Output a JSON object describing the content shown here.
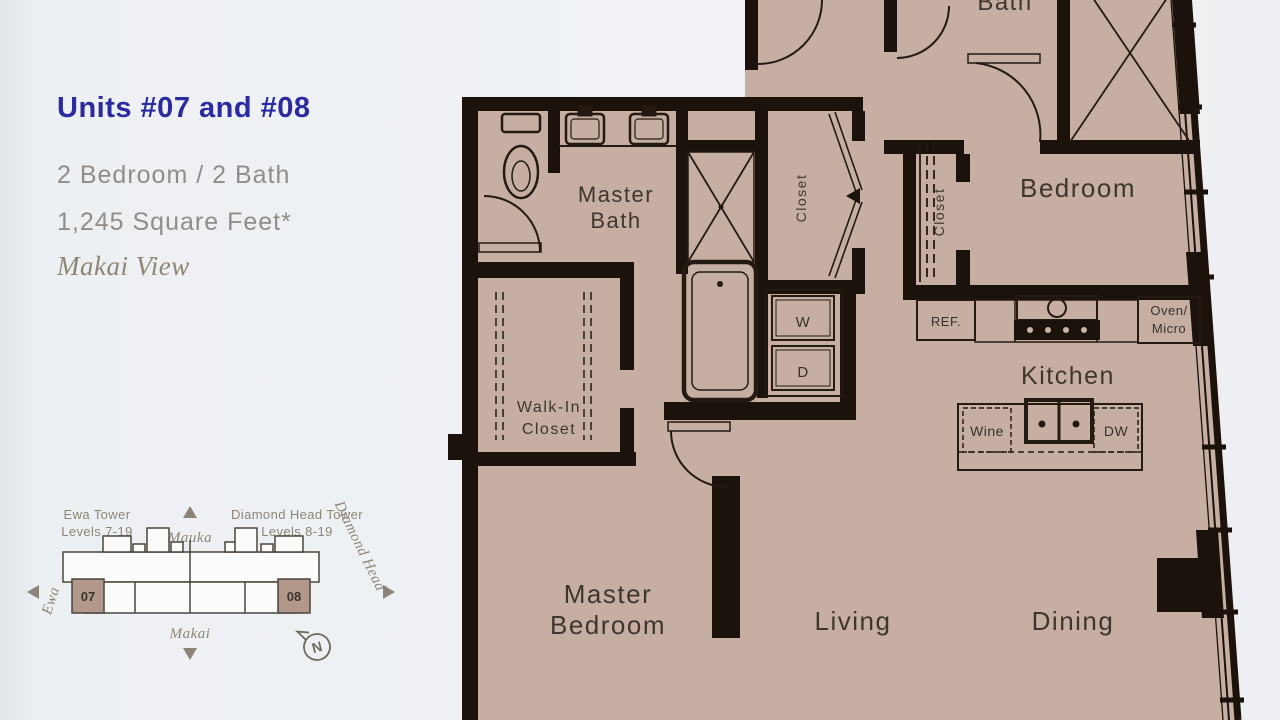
{
  "colors": {
    "background": "#eef1f4",
    "plan_fill": "#c6aea3",
    "wall": "#1a120b",
    "accent_blue": "#2b2aa0",
    "spec_gray": "#8f8d8b",
    "serif_gray": "#8d8673",
    "room_label": "#41362d",
    "locator_gray": "#8c8577",
    "unit_badge": "#b2978b"
  },
  "info": {
    "title": "Units #07 and #08",
    "specs": "2 Bedroom / 2 Bath",
    "area": "1,245 Square Feet*",
    "view": "Makai View"
  },
  "locator": {
    "left_tower_name": "Ewa Tower",
    "left_tower_levels": "Levels 7-19",
    "right_tower_name": "Diamond Head Tower",
    "right_tower_levels": "Levels 8-19",
    "dir_mauka": "Mauka",
    "dir_makai": "Makai",
    "dir_ewa": "Ewa",
    "dir_diamond_head": "Diamond Head",
    "unit_left": "07",
    "unit_right": "08",
    "compass_n": "N"
  },
  "plan": {
    "labels": {
      "master_bath_1": "Master",
      "master_bath_2": "Bath",
      "bath2": "Bath",
      "hall_closet": "Closet",
      "bedroom_closet": "Closet",
      "bedroom": "Bedroom",
      "kitchen": "Kitchen",
      "walk_in_1": "Walk-In",
      "walk_in_2": "Closet",
      "master_bedroom_1": "Master",
      "master_bedroom_2": "Bedroom",
      "living": "Living",
      "dining": "Dining",
      "ref": "REF.",
      "oven_1": "Oven/",
      "oven_2": "Micro",
      "wine": "Wine",
      "dw": "DW",
      "washer": "W",
      "dryer": "D"
    }
  }
}
